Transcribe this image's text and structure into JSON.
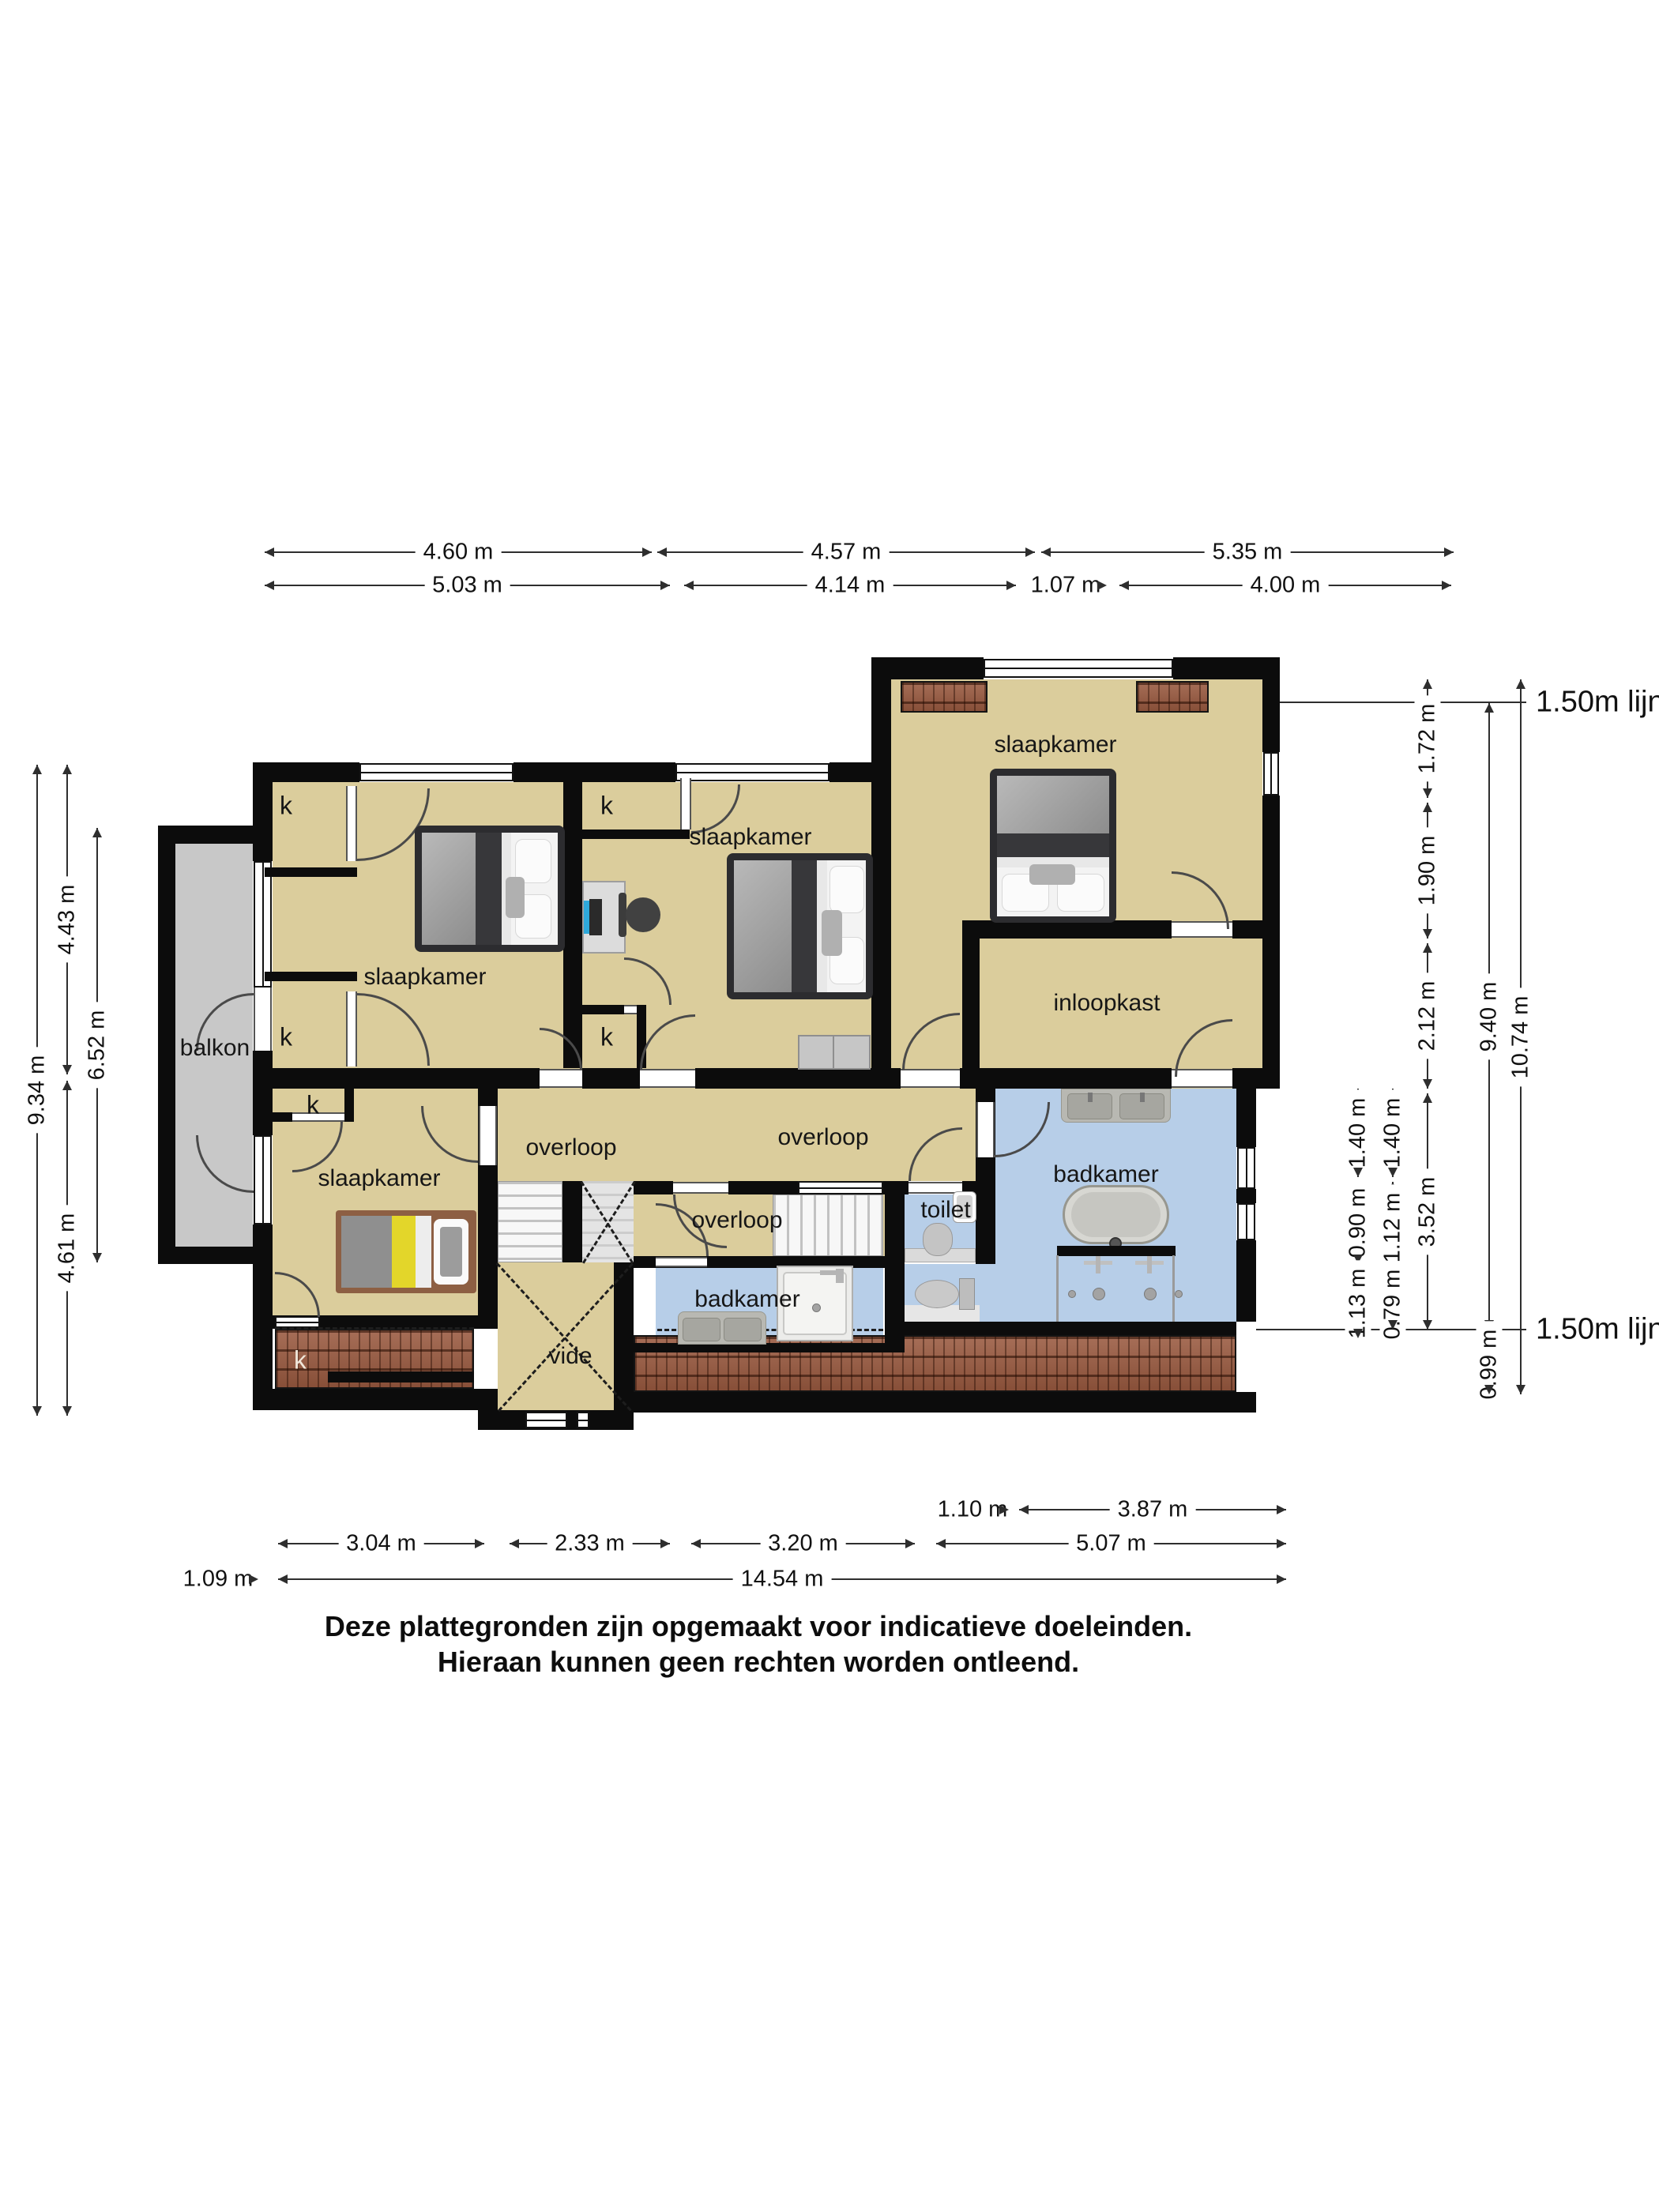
{
  "rooms": {
    "slaapkamer": "slaapkamer",
    "inloopkast": "inloopkast",
    "badkamer": "badkamer",
    "overloop": "overloop",
    "toilet": "toilet",
    "vide": "vide",
    "balkon": "balkon",
    "closet": "k"
  },
  "ref": {
    "label": "1.50m lijn"
  },
  "dims": {
    "top1": [
      "4.60 m",
      "4.57 m",
      "5.35 m"
    ],
    "top2": [
      "5.03 m",
      "4.14 m",
      "1.07 m",
      "4.00 m"
    ],
    "left": {
      "total": "9.34 m",
      "top": "4.43 m",
      "bottom": "4.61 m",
      "balkon": "6.52 m"
    },
    "right1": [
      "1.40 m",
      "0.90 m",
      "1.13 m"
    ],
    "right2": [
      "1.40 m",
      "1.12 m",
      "0.79 m"
    ],
    "right3": [
      "1.72 m",
      "1.90 m",
      "2.12 m",
      "3.52 m"
    ],
    "right4": [
      "9.40 m",
      "0.99 m"
    ],
    "right5": [
      "10.74 m"
    ],
    "bottom1": [
      "1.10 m",
      "3.87 m"
    ],
    "bottom2": [
      "3.04 m",
      "2.33 m",
      "3.20 m",
      "5.07 m"
    ],
    "bottom3": [
      "1.09 m",
      "14.54 m"
    ]
  },
  "colors": {
    "wall": "#0c0c0c",
    "floor": "#dbcd9c",
    "bath": "#b7cee8",
    "balcony": "#c8c8c8",
    "roof": "#9a5a40"
  },
  "footer": {
    "line1": "Deze plattegronden zijn opgemaakt voor indicatieve doeleinden.",
    "line2": "Hieraan kunnen geen rechten worden ontleend."
  }
}
